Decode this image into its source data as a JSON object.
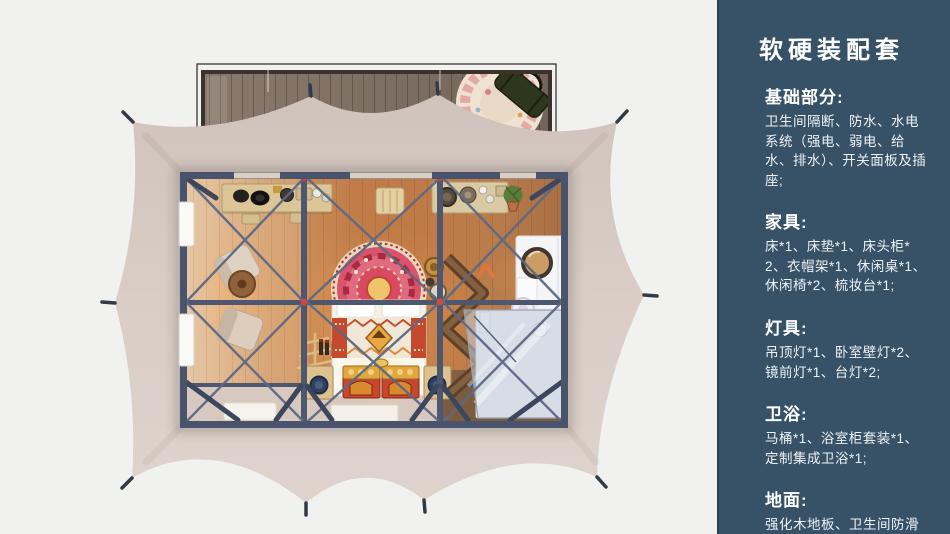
{
  "page": {
    "background": "#f1f1f0"
  },
  "sidebar": {
    "background": "#375267",
    "title": "软硬装配套",
    "sections": [
      {
        "heading": "基础部分:",
        "body": "卫生间隔断、防水、水电系统（强电、弱电、给水、排水）、开关面板及插座;"
      },
      {
        "heading": "家具:",
        "body": "床*1、床垫*1、床头柜*2、衣帽架*1、休闲桌*1、休闲椅*2、梳妆台*1;"
      },
      {
        "heading": "灯具:",
        "body": "吊顶灯*1、卧室壁灯*2、镜前灯*1、台灯*2;"
      },
      {
        "heading": "卫浴:",
        "body": "马桶*1、浴室柜套装*1、定制集成卫浴*1;"
      },
      {
        "heading": "地面:",
        "body": "强化木地板、卫生间防滑防潮石塑板;"
      }
    ]
  },
  "floorplan": {
    "description": "top-down render of a framed glamping tent suite",
    "colors": {
      "canvas": "#d8ccc5",
      "frame": "#4a546c",
      "floor_wood": "#c07a47",
      "deck_wood": "#7b6b5f",
      "porch": "#d7c9c0",
      "accent_red": "#d6463c",
      "headboard_pink": "#d9536d",
      "bathroom_glass": "#c2cedd"
    },
    "items": [
      "wood-deck",
      "round-rug",
      "duffel-bag",
      "tent-canopy",
      "steel-frame",
      "console-desk",
      "lounge-chair",
      "lounge-chair",
      "round-side-table",
      "bed",
      "arched-headboard",
      "dowry-trunk",
      "dowry-trunk",
      "nightstand",
      "nightstand",
      "coat-rack",
      "zigzag-shelf",
      "dressing-table",
      "vanity-mirror",
      "stool",
      "tea-console",
      "potted-plant",
      "integrated-bathroom",
      "shower-glass",
      "window-panel",
      "window-panel",
      "floor-mat",
      "floor-mat"
    ]
  }
}
